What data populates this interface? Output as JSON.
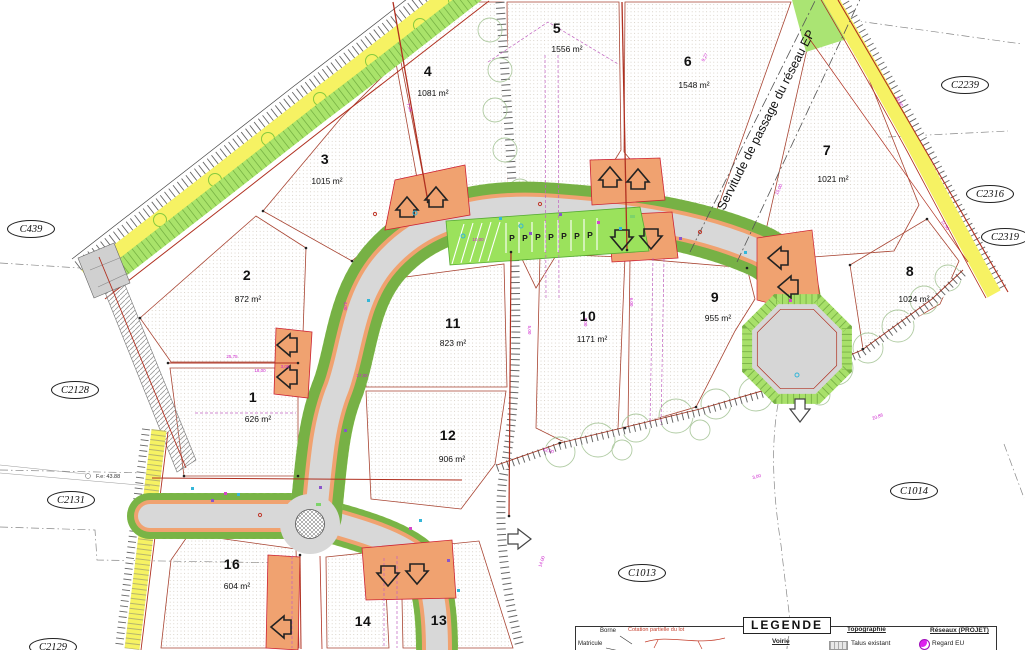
{
  "lots": [
    {
      "num": "1",
      "area": "626 m²"
    },
    {
      "num": "2",
      "area": "872 m²"
    },
    {
      "num": "3",
      "area": "1015 m²"
    },
    {
      "num": "4",
      "area": "1081 m²"
    },
    {
      "num": "5",
      "area": "1556 m²"
    },
    {
      "num": "6",
      "area": "1548 m²"
    },
    {
      "num": "7",
      "area": "1021 m²"
    },
    {
      "num": "8",
      "area": "1024 m²"
    },
    {
      "num": "9",
      "area": "955 m²"
    },
    {
      "num": "10",
      "area": "1171 m²"
    },
    {
      "num": "11",
      "area": "823 m²"
    },
    {
      "num": "12",
      "area": "906 m²"
    },
    {
      "num": "13",
      "area": ""
    },
    {
      "num": "14",
      "area": ""
    },
    {
      "num": "16",
      "area": "604 m²"
    }
  ],
  "parcels": [
    "C439",
    "C2128",
    "C2131",
    "C2129",
    "C2239",
    "C2316",
    "C2319",
    "C1014",
    "C1013"
  ],
  "servitude_label": "Servitude de passage du réseau EP",
  "level_note": "F.e: 43.88",
  "parking_symbol": "P",
  "legend": {
    "title": "LEGENDE",
    "borne": "Borne",
    "matricule": "Matricule",
    "cotation": "Cotation partielle du lot",
    "voirie": "Voirie",
    "topographie": "Topographie",
    "talus": "Talus existant",
    "reseaux": "Réseaux (PROJET)",
    "regard": "Regard EU"
  },
  "dims": [
    "17,00",
    "25,75",
    "18,00",
    "3,00",
    "5,00",
    "8,00",
    "23,00",
    "12,00",
    "9,27",
    "7,48",
    "15,00",
    "20,86",
    "11,50",
    "4,00",
    "6,00",
    "10,00",
    "14,00",
    "3,00"
  ],
  "colors": {
    "road": "#d8d8d8",
    "access_orange": "#f0a270",
    "verge_green": "#abe46b",
    "band_yellow": "#f6f263",
    "dims_magenta": "#cc22cc",
    "boundary_red": "#b03020",
    "regard_magenta": "#dd22ee"
  }
}
